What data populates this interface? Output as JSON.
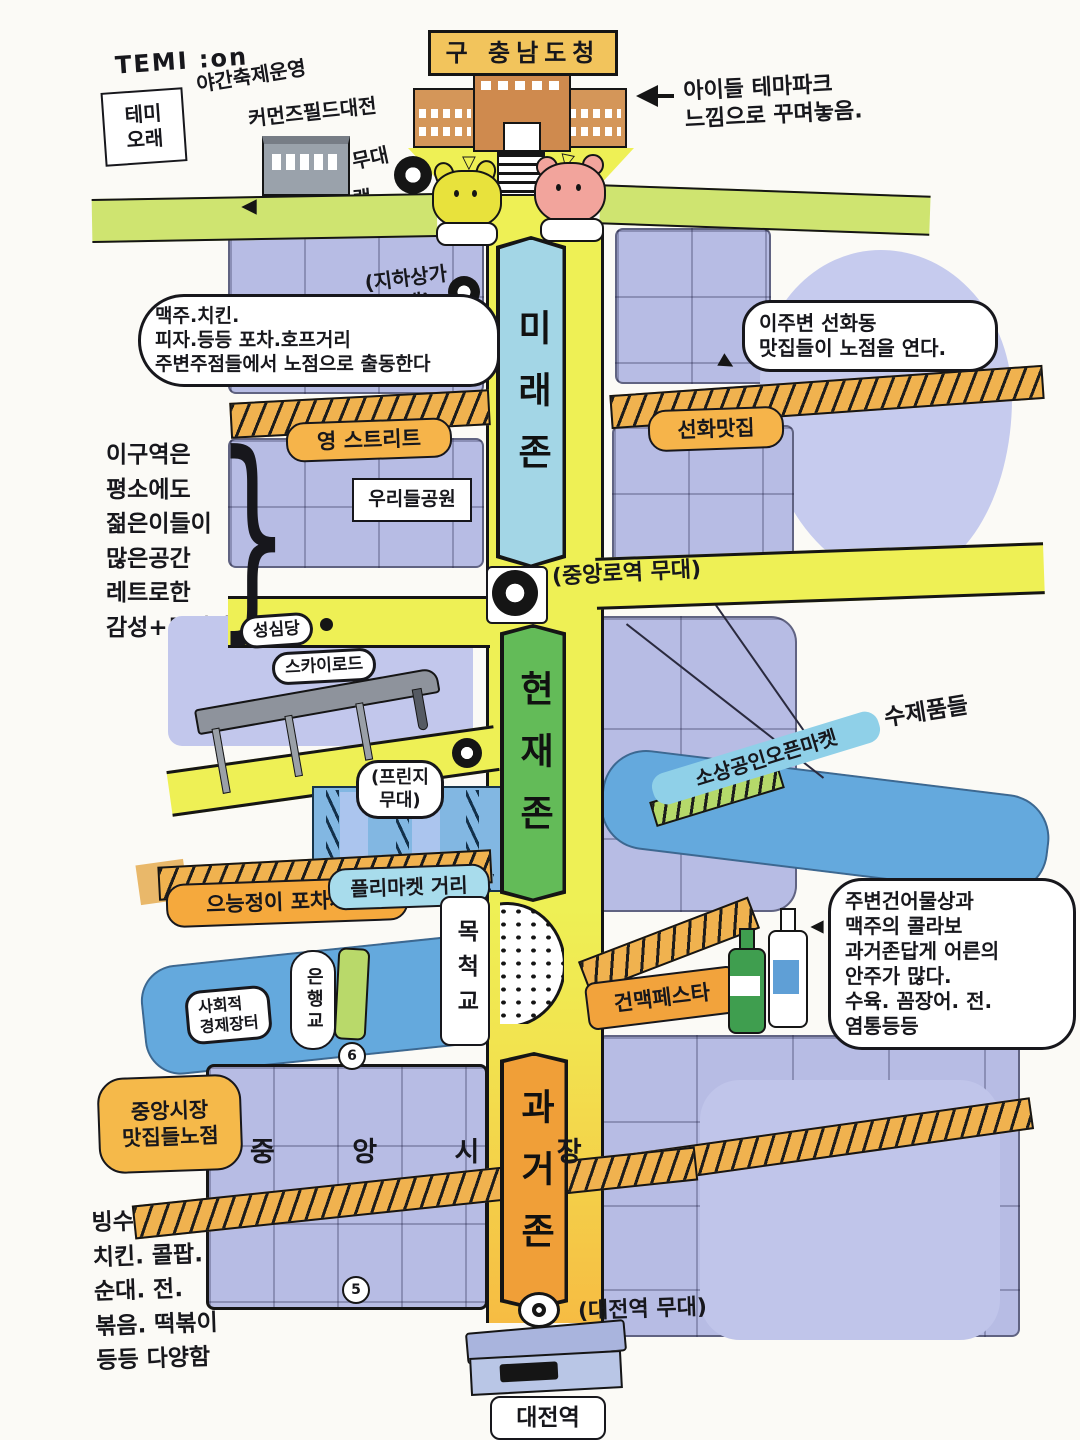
{
  "palette": {
    "road_yellow": "#eef055",
    "zone_future": "#a3d6e6",
    "zone_present": "#63bb58",
    "zone_past": "#f09f38",
    "river_blue": "#64a9dd",
    "label_orange": "#f6b44a",
    "block_purple": "#b7bce4"
  },
  "top": {
    "temion": "TEMI :on",
    "night_festival": "야간축제운영",
    "temi_orae": "테미\n오래",
    "commons_field": "커먼즈필드대전",
    "stage_word": "무대",
    "experience_program": "체험프로그램\n운영",
    "old_office": "구 충남도청",
    "theme_park_note": "아이들 테마파크\n느낌으로 꾸며놓음.",
    "underground_stage": "(지하상가\n무대)",
    "plaza_mark": "▽"
  },
  "zones": {
    "future": "미래존",
    "present": "현재존",
    "past": "과거존"
  },
  "stages": {
    "jungangno": "(중앙로역 무대)",
    "fringe": "(프린지\n무대)",
    "daejeon": "(대전역 무대)"
  },
  "bubbles": {
    "pub_note": "맥주.치킨.\n피자.등등 포차.호프거리\n주변주점들에서 노점으로 출동한다",
    "seonhwa_note": "이주변 선화동\n맛집들이 노점을 연다.",
    "youth_note": "이구역은\n평소에도\n젊은이들이\n많은공간\n레트로한\n감성+트렌디",
    "adult_note": "주변건어물상과\n맥주의 콜라보\n과거존답게 어른의\n안주가 많다.\n수육. 꼼장어. 전.\n염통등등",
    "market_stalls": "중앙시장\n맛집들노점",
    "foods_note": "빙수. 피자.\n치킨. 콜팝.\n순대. 전.\n볶음. 떡볶이\n등등 다양함",
    "social_market": "사회적\n경제장터"
  },
  "places": {
    "young_street": "영 스트리트",
    "seonhwa_matjip": "선화맛집",
    "urideul_park": "우리들공원",
    "sungsimdang": "성심당",
    "sky_road": "스카이로드",
    "flea_street": "플리마켓 거리",
    "pocha_street": "으능정이 포차거리",
    "open_market": "소상공인오픈마켓",
    "handmade": "수제품들",
    "mokcheok": "목척교",
    "eunhaeng": "은행교",
    "geonmaek": "건맥페스타",
    "jungang_market": "중 앙 시 장",
    "daejeon_station": "대전역"
  },
  "markers": {
    "n5": "5",
    "n6": "6"
  }
}
